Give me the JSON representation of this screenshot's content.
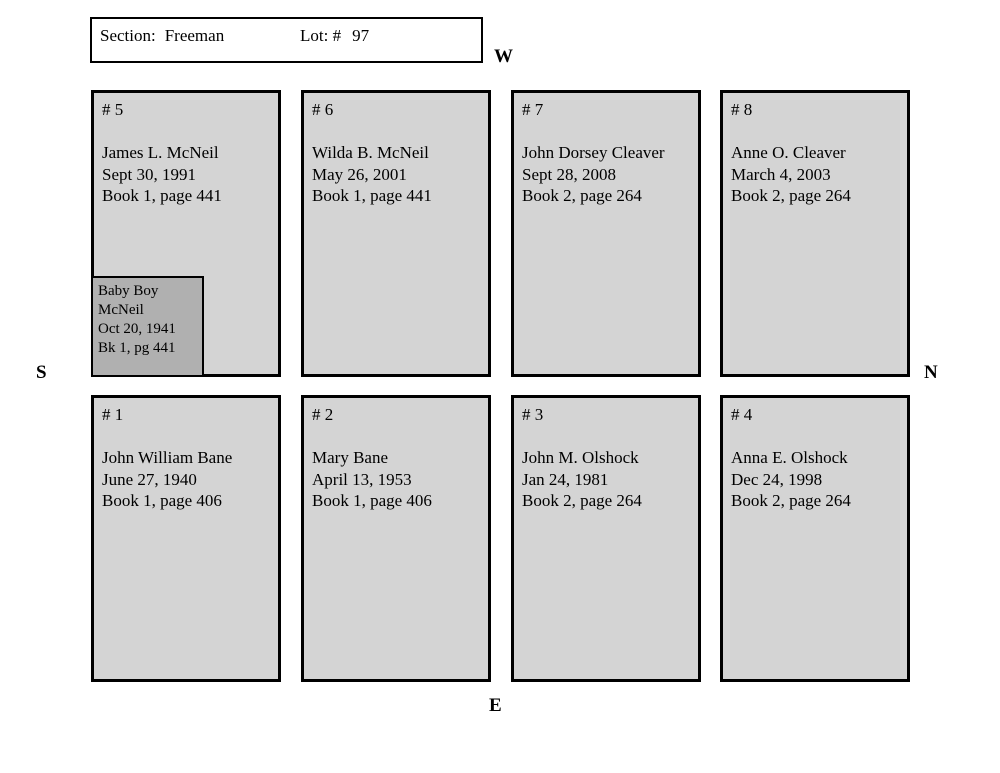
{
  "header": {
    "section_label": "Section:",
    "section_value": "Freeman",
    "lot_label": "Lot: #",
    "lot_value": "97"
  },
  "compass": {
    "west": "W",
    "south": "S",
    "north": "N",
    "east": "E"
  },
  "plots": [
    {
      "number": "# 5",
      "lines": [
        "James L. McNeil",
        "Sept 30, 1991",
        "Book 1, page 441"
      ],
      "inner": {
        "lines": [
          "Baby Boy",
          "McNeil",
          "Oct 20, 1941",
          "Bk 1, pg 441"
        ]
      }
    },
    {
      "number": "# 6",
      "lines": [
        "Wilda B. McNeil",
        "May 26, 2001",
        "Book 1, page 441"
      ]
    },
    {
      "number": "# 7",
      "lines": [
        "John Dorsey Cleaver",
        "Sept 28, 2008",
        "Book 2, page 264"
      ]
    },
    {
      "number": "# 8",
      "lines": [
        "Anne O. Cleaver",
        "March 4, 2003",
        "Book 2, page 264"
      ]
    },
    {
      "number": "# 1",
      "lines": [
        "John William Bane",
        "June 27, 1940",
        "Book 1, page 406"
      ]
    },
    {
      "number": "# 2",
      "lines": [
        "Mary Bane",
        "April 13, 1953",
        "Book 1, page 406"
      ]
    },
    {
      "number": "# 3",
      "lines": [
        "John M. Olshock",
        "Jan 24, 1981",
        "Book 2, page 264"
      ]
    },
    {
      "number": "# 4",
      "lines": [
        "Anna E. Olshock",
        "Dec 24, 1998",
        "Book 2, page 264"
      ]
    }
  ],
  "colors": {
    "plot_fill": "#d4d4d4",
    "inner_fill": "#b0b0b0",
    "border_color": "#000000",
    "page_bg": "#ffffff"
  }
}
